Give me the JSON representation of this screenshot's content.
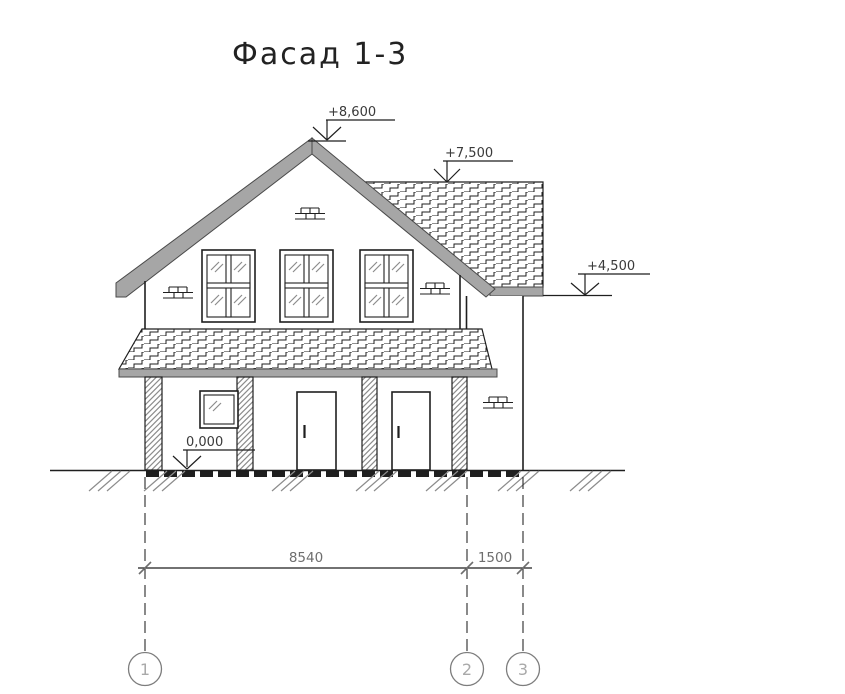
{
  "title": "Фасад 1-3",
  "levels": {
    "ridge": {
      "label": "+8,600"
    },
    "side_roof": {
      "label": "+7,500"
    },
    "eaves": {
      "label": "+4,500"
    },
    "ground": {
      "label": "0,000"
    }
  },
  "dimensions": {
    "axis_1_2": "8540",
    "axis_2_3": "1500"
  },
  "axes": [
    {
      "label": "1"
    },
    {
      "label": "2"
    },
    {
      "label": "3"
    }
  ],
  "colors": {
    "ink": "#1f1f1f",
    "roof_fill": "#a6a6a6",
    "roof_edge": "#4a4a4a",
    "hatch_gray": "#8c8c8c",
    "dim_text": "#6e6e6e",
    "axis_bubble": "#7d7d7d",
    "axis_digit": "#a9a9a9",
    "background": "#ffffff"
  }
}
